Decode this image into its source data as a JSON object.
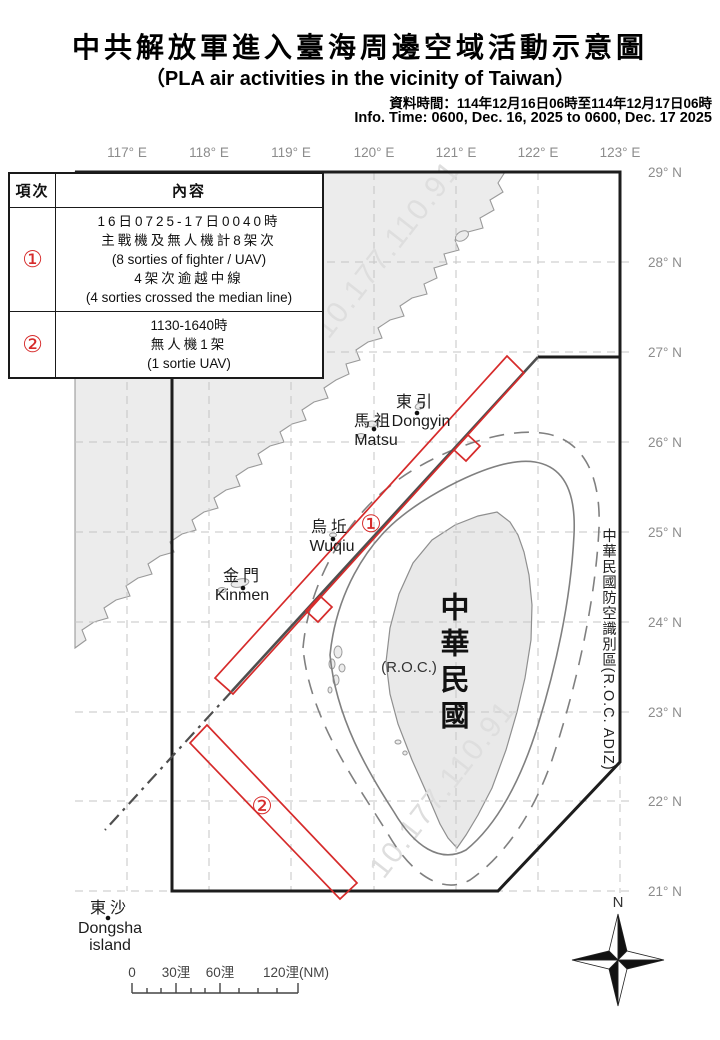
{
  "header": {
    "title_zh": "中共解放軍進入臺海周邊空域活動示意圖",
    "title_en": "（PLA air activities in the vicinity of Taiwan）",
    "info_zh": "資料時間：114年12月16日06時至114年12月17日06時",
    "info_en": "Info. Time: 0600, Dec. 16, 2025 to 0600, Dec. 17 2025"
  },
  "table": {
    "col1_header": "項次",
    "col2_header": "內容",
    "rows": [
      {
        "num": "①",
        "lines": [
          "16日0725-17日0040時",
          "主戰機及無人機計8架次",
          "(8 sorties of fighter / UAV)",
          "4架次逾越中線",
          "(4 sorties crossed the median line)"
        ]
      },
      {
        "num": "②",
        "lines": [
          "1130-1640時",
          "無人機1架",
          "(1 sortie UAV)"
        ]
      }
    ]
  },
  "map": {
    "lon_labels": [
      "117° E",
      "118° E",
      "119° E",
      "120° E",
      "121° E",
      "122° E",
      "123° E"
    ],
    "lat_labels": [
      "29° N",
      "28° N",
      "27° N",
      "26° N",
      "25° N",
      "24° N",
      "23° N",
      "22° N",
      "21° N"
    ],
    "adiz_label": "中華民國防空識別區(R.O.C. ADIZ)",
    "places": {
      "dongyin": {
        "zh": "東引",
        "en": "Dongyin"
      },
      "matsu": {
        "zh": "馬祖",
        "en": "Matsu"
      },
      "wuqiu": {
        "zh": "烏坵",
        "en": "Wuqiu"
      },
      "kinmen": {
        "zh": "金門",
        "en": "Kinmen"
      },
      "dongsha": {
        "zh": "東沙",
        "en1": "Dongsha",
        "en2": "island"
      },
      "taiwan_zh": "中華民國",
      "taiwan_en": "(R.O.C.)"
    },
    "markers": {
      "m1": "①",
      "m2": "②"
    },
    "watermark": "10.177.110.91",
    "north_label": "N",
    "scale": {
      "zero": "0",
      "thirty": "30浬",
      "sixty": "60浬",
      "onetwenty": "120浬(NM)"
    }
  },
  "colors": {
    "accent_red": "#d62b2b",
    "land_fill": "#ececec",
    "boundary_black": "#1d1d1d",
    "median_gray": "#4f4f4f",
    "grid_gray": "#c5c5c5",
    "muted_label": "#8c8c8c"
  }
}
